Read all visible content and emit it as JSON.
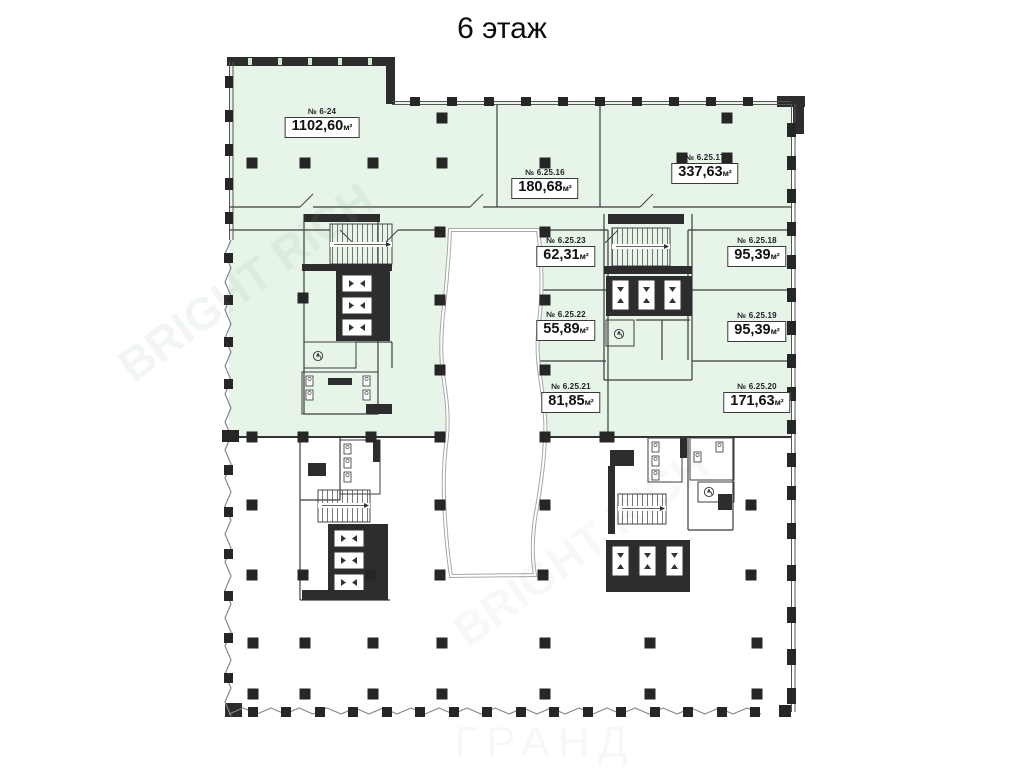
{
  "title": "6 этаж",
  "unit": "м²",
  "watermark_bottom": "ГРАНД",
  "watermark_diag": "BRIGHT RICH",
  "legend": {
    "available_meaning": "available-area-highlight"
  },
  "colors": {
    "available_fill": "#e7f4e8",
    "wall": "#2d2d2d",
    "thin_line": "#3c3c3c",
    "atrium_line": "#9c9c9c"
  },
  "rooms": [
    {
      "id": "6-24",
      "number": "№ 6-24",
      "area": "1102,60"
    },
    {
      "id": "6.25.16",
      "number": "№ 6.25.16",
      "area": "180,68"
    },
    {
      "id": "6.25.17",
      "number": "№ 6.25.17",
      "area": "337,63"
    },
    {
      "id": "6.25.23",
      "number": "№ 6.25.23",
      "area": "62,31"
    },
    {
      "id": "6.25.18",
      "number": "№ 6.25.18",
      "area": "95,39"
    },
    {
      "id": "6.25.22",
      "number": "№ 6.25.22",
      "area": "55,89"
    },
    {
      "id": "6.25.19",
      "number": "№ 6.25.19",
      "area": "95,39"
    },
    {
      "id": "6.25.21",
      "number": "№ 6.25.21",
      "area": "81,85"
    },
    {
      "id": "6.25.20",
      "number": "№ 6.25.20",
      "area": "171,63"
    }
  ]
}
